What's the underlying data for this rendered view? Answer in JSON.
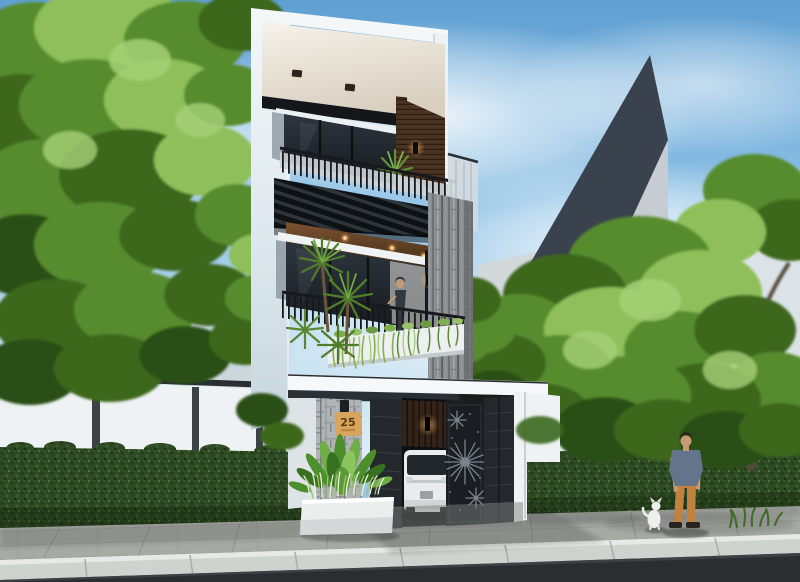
{
  "scene": {
    "house_number": "25",
    "palette": {
      "sky_top": "#5f9fd2",
      "sky_mid": "#8fc2e6",
      "sky_horizon": "#ddeef7",
      "foliage_light": "#8fbf5a",
      "foliage_mid": "#578c2f",
      "foliage_dark": "#3c681f",
      "hedge_green": "#2e4a24",
      "wall_white": "#f2f5f6",
      "wood_accent": "#4a3322",
      "stone_gray": "#8b8e90",
      "gate_dark": "#24272c",
      "pavement_gray": "#a6a9a4",
      "curb_light": "#cfd3cf",
      "road_asphalt": "#2b2e31",
      "plaque_tan": "#d9a55e",
      "plaque_text": "#5a3a14",
      "shirt_blue": "#64748a",
      "pants_orange": "#c1823f",
      "warm_light": "#ffb45e",
      "background_building": "#39424d"
    }
  }
}
